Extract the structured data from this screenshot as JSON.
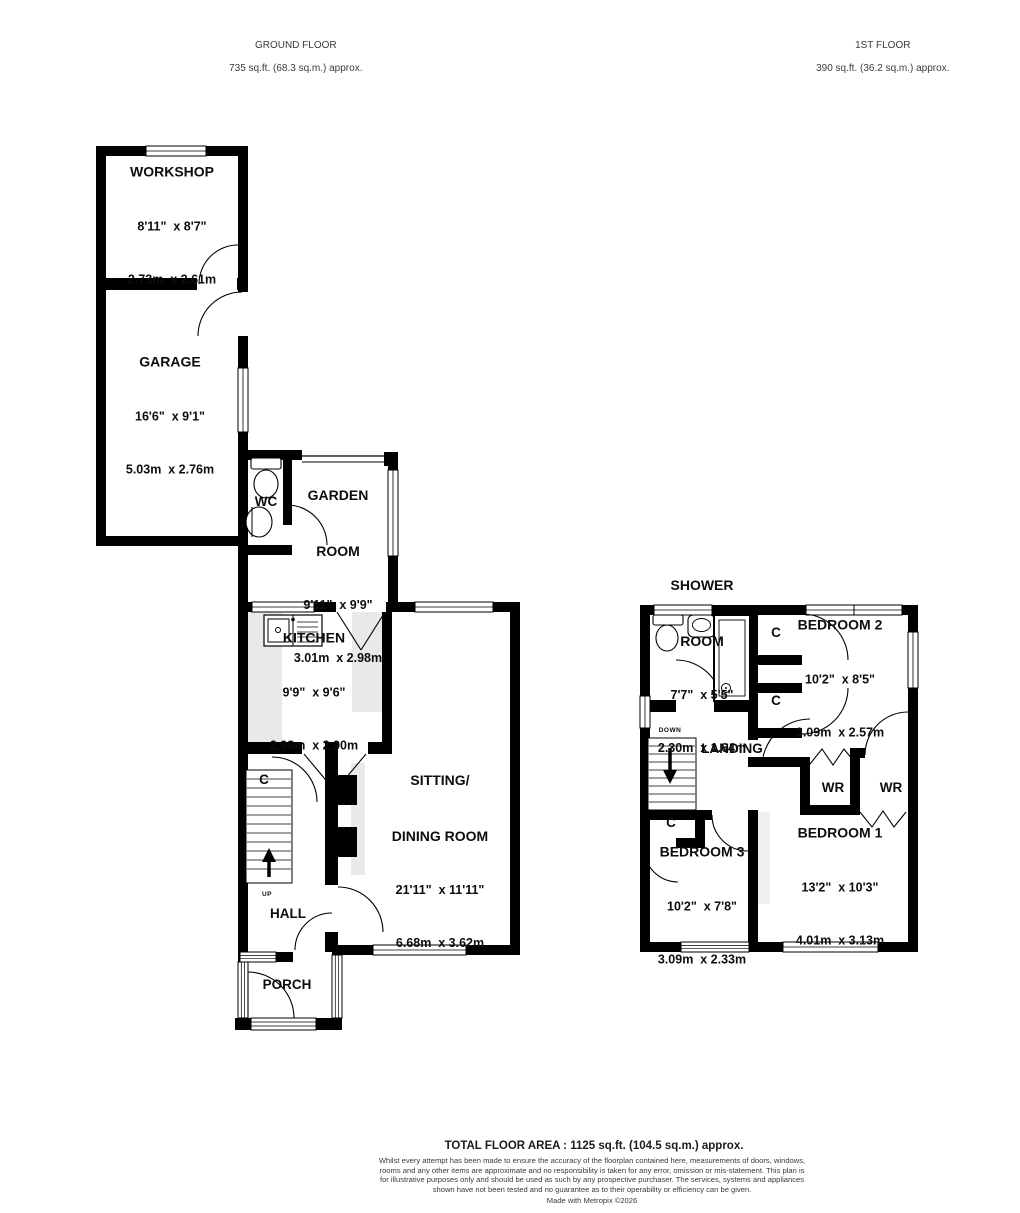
{
  "header": {
    "ground_floor": {
      "title": "GROUND FLOOR",
      "area": "735 sq.ft. (68.3 sq.m.) approx."
    },
    "first_floor": {
      "title": "1ST FLOOR",
      "area": "390 sq.ft. (36.2 sq.m.) approx."
    }
  },
  "ground_floor": {
    "workshop": {
      "name": "WORKSHOP",
      "imperial": "8'11\"  x 8'7\"",
      "metric": "2.73m  x 2.61m"
    },
    "garage": {
      "name": "GARAGE",
      "imperial": "16'6\"  x 9'1\"",
      "metric": "5.03m  x 2.76m"
    },
    "wc": {
      "name": "WC"
    },
    "garden_room": {
      "name_line1": "GARDEN",
      "name_line2": "ROOM",
      "imperial": "9'11\"  x 9'9\"",
      "metric": "3.01m  x 2.98m"
    },
    "kitchen": {
      "name": "KITCHEN",
      "imperial": "9'9\"  x 9'6\"",
      "metric": "2.98m  x 2.90m"
    },
    "sitting_dining": {
      "name_line1": "SITTING/",
      "name_line2": "DINING ROOM",
      "imperial": "21'11\"  x 11'11\"",
      "metric": "6.68m  x 3.62m"
    },
    "hall": {
      "name": "HALL"
    },
    "porch": {
      "name": "PORCH"
    },
    "cupboard": {
      "name": "C"
    },
    "stairs_up": {
      "name": "UP"
    }
  },
  "first_floor": {
    "shower_room": {
      "name_line1": "SHOWER",
      "name_line2": "ROOM",
      "imperial": "7'7\"  x 5'5\"",
      "metric": "2.30m  x 1.64m"
    },
    "bedroom2": {
      "name": "BEDROOM 2",
      "imperial": "10'2\"  x 8'5\"",
      "metric": "3.09m  x 2.57m"
    },
    "landing": {
      "name": "LANDING"
    },
    "stairs_down": {
      "name": "DOWN"
    },
    "cupboard_top": {
      "name": "C"
    },
    "cupboard_mid": {
      "name": "C"
    },
    "cupboard_bed3": {
      "name": "C"
    },
    "wardrobe1": {
      "name": "WR"
    },
    "wardrobe2": {
      "name": "WR"
    },
    "bedroom3": {
      "name": "BEDROOM 3",
      "imperial": "10'2\"  x 7'8\"",
      "metric": "3.09m  x 2.33m"
    },
    "bedroom1": {
      "name": "BEDROOM 1",
      "imperial": "13'2\"  x 10'3\"",
      "metric": "4.01m  x 3.13m"
    }
  },
  "footer": {
    "total": "TOTAL FLOOR AREA : 1125 sq.ft. (104.5 sq.m.) approx.",
    "disclaimer": "Whilst every attempt has been made to ensure the accuracy of the floorplan contained here, measurements of doors, windows, rooms and any other items are approximate and no responsibility is taken for any error, omission or mis-statement. This plan is for illustrative purposes only and should be used as such by any prospective purchaser. The services, systems and appliances shown have not been tested and no guarantee as to their operability or efficiency can be given.",
    "credit": "Made with Metropix ©2026"
  },
  "colors": {
    "wall": "#000000",
    "counter": "#e9e9e9",
    "background": "#ffffff"
  }
}
